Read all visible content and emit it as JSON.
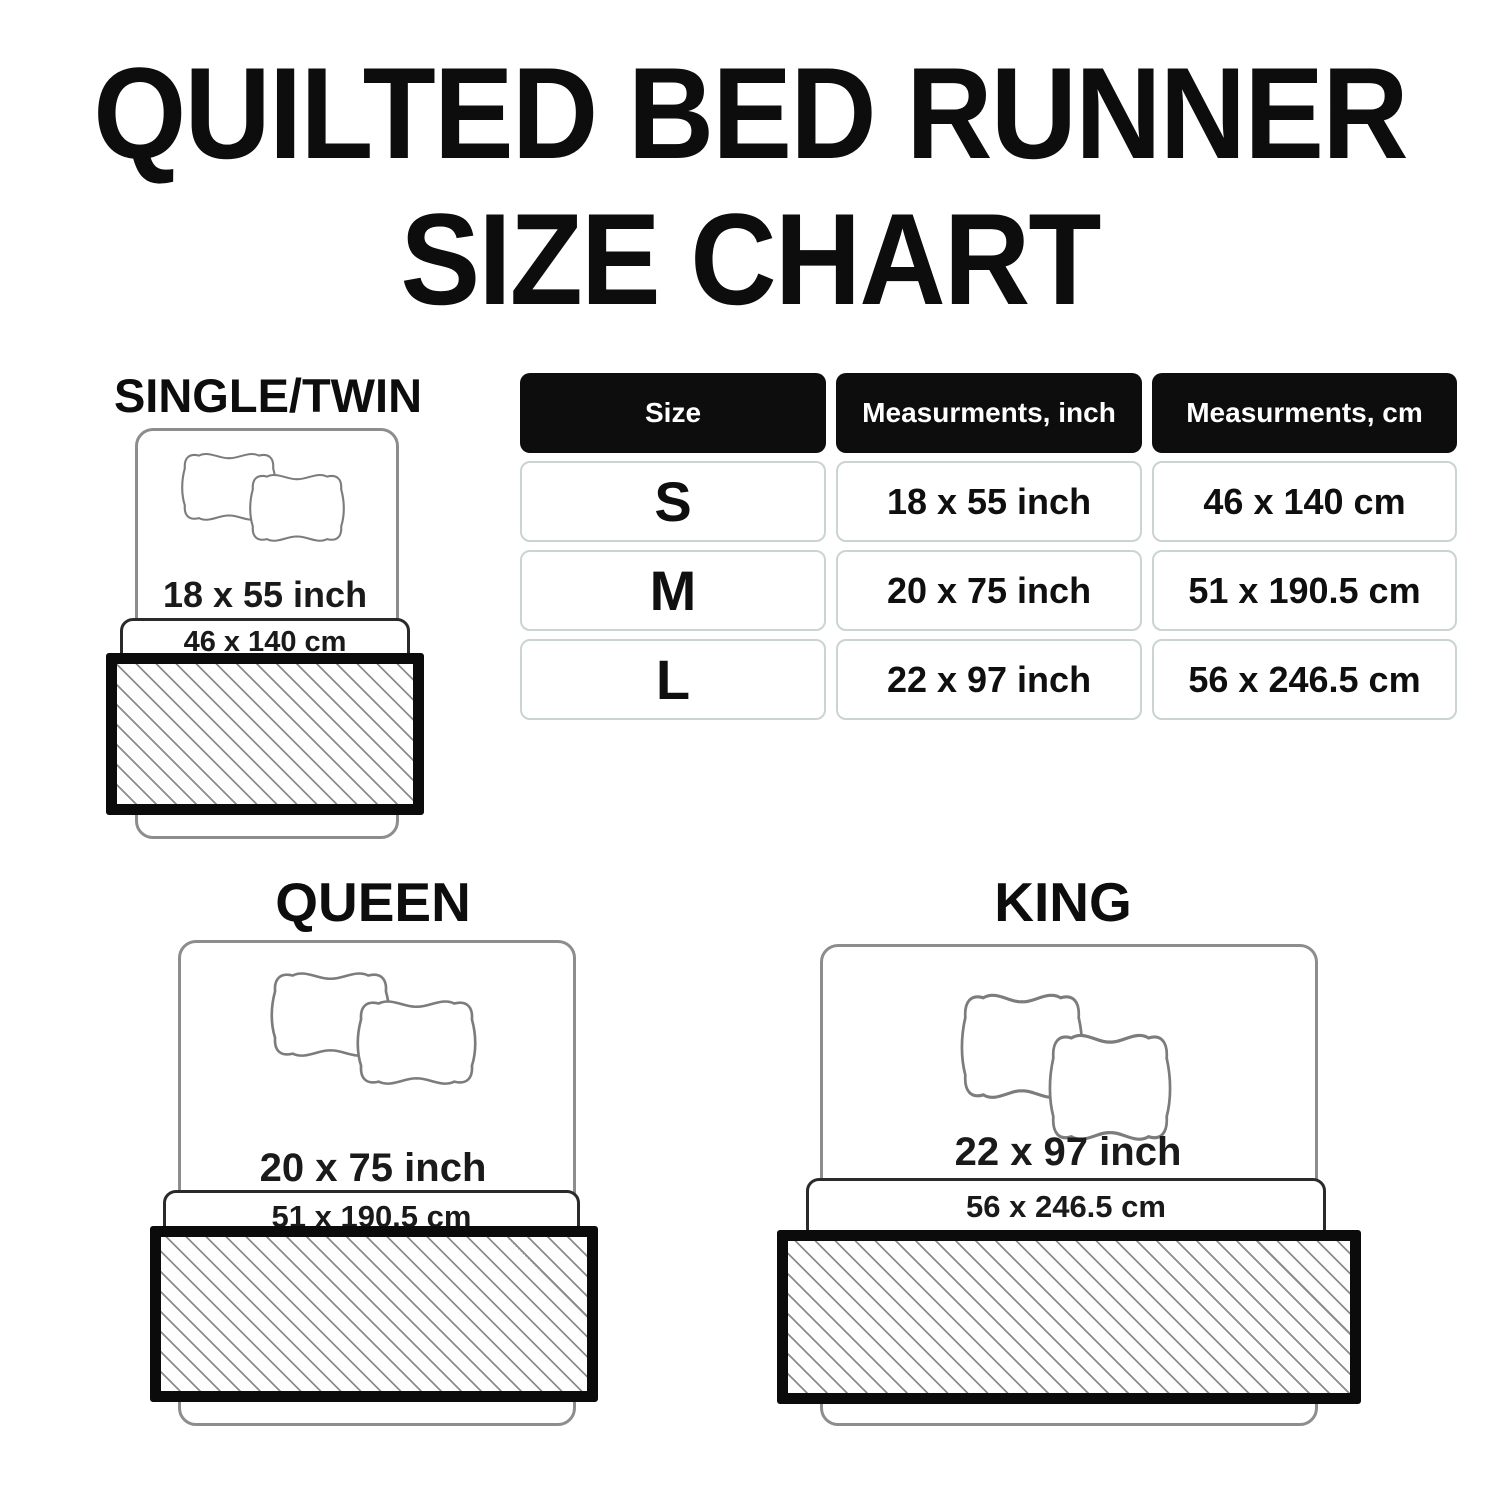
{
  "title": {
    "line1": "QUILTED BED RUNNER",
    "line2": "SIZE CHART"
  },
  "table": {
    "headers": {
      "size": "Size",
      "inch": "Measurments, inch",
      "cm": "Measurments, cm"
    },
    "rows": [
      {
        "size": "S",
        "inch": "18 x 55 inch",
        "cm": "46 x 140 cm"
      },
      {
        "size": "M",
        "inch": "20 x 75 inch",
        "cm": "51 x 190.5 cm"
      },
      {
        "size": "L",
        "inch": "22 x 97 inch",
        "cm": "56 x 246.5 cm"
      }
    ]
  },
  "diagrams": {
    "single": {
      "label": "SINGLE/TWIN",
      "inch": "18 x 55 inch",
      "cm": "46 x 140 cm"
    },
    "queen": {
      "label": "QUEEN",
      "inch": "20 x 75 inch",
      "cm": "51 x 190.5 cm"
    },
    "king": {
      "label": "KING",
      "inch": "22 x 97 inch",
      "cm": "56 x 246.5 cm"
    }
  },
  "colors": {
    "text": "#111111",
    "header_bg": "#0d0d0d",
    "header_text": "#ffffff",
    "cell_border": "#c9d4d3",
    "bed_outline": "#8d8d8d",
    "band_border": "#2a2a2a",
    "runner_border": "#0b0b0b",
    "hatch_line": "#8c8c8c"
  }
}
